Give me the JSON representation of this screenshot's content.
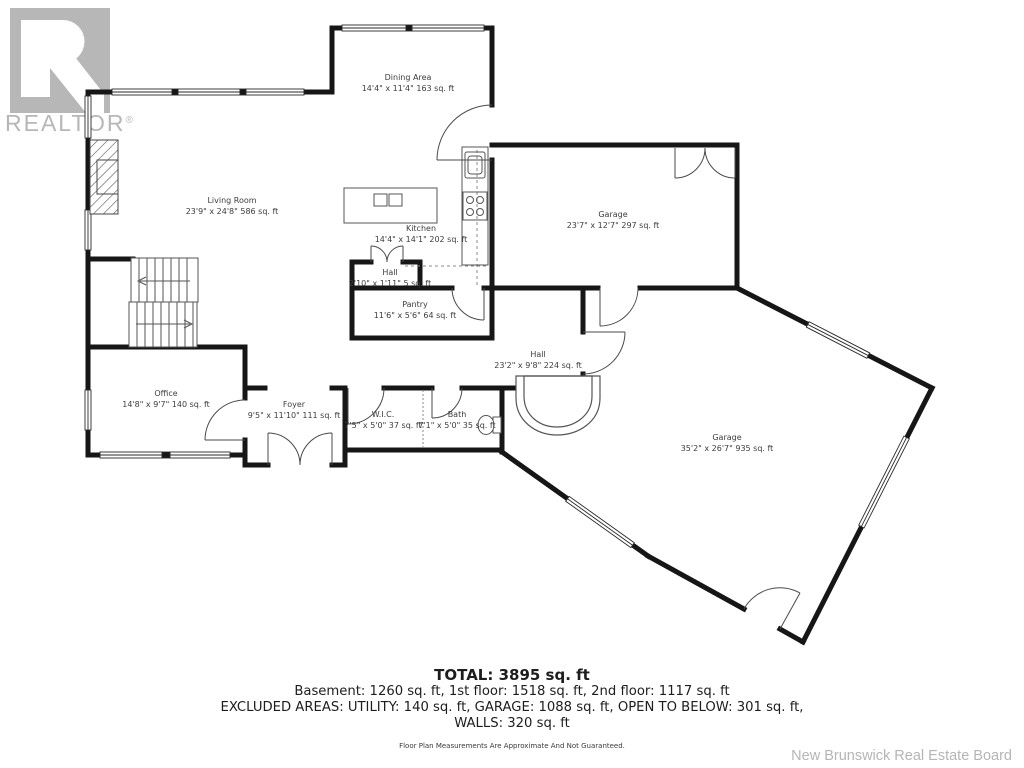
{
  "branding": {
    "logo_text": "REALTOR",
    "logo_reg": "®",
    "logo_color": "#b7b7b7"
  },
  "rooms": [
    {
      "id": "dining-area",
      "name": "Dining Area",
      "dims": "14'4\" x 11'4\" 163 sq. ft"
    },
    {
      "id": "living-room",
      "name": "Living Room",
      "dims": "23'9\" x 24'8\" 586 sq. ft"
    },
    {
      "id": "kitchen",
      "name": "Kitchen",
      "dims": "14'4\" x 14'1\" 202 sq. ft"
    },
    {
      "id": "garage-upper",
      "name": "Garage",
      "dims": "23'7\" x 12'7\" 297 sq. ft"
    },
    {
      "id": "hall-small",
      "name": "Hall",
      "dims": "2'10\" x 1'11\" 5 sq. ft"
    },
    {
      "id": "pantry",
      "name": "Pantry",
      "dims": "11'6\" x 5'6\" 64 sq. ft"
    },
    {
      "id": "hall-main",
      "name": "Hall",
      "dims": "23'2\" x 9'8\" 224 sq. ft"
    },
    {
      "id": "office",
      "name": "Office",
      "dims": "14'8\" x 9'7\" 140 sq. ft"
    },
    {
      "id": "foyer",
      "name": "Foyer",
      "dims": "9'5\" x 11'10\" 111 sq. ft"
    },
    {
      "id": "wic",
      "name": "W.I.C.",
      "dims": "7'5\" x 5'0\" 37 sq. ft"
    },
    {
      "id": "bath",
      "name": "Bath",
      "dims": "7'1\" x 5'0\" 35 sq. ft"
    },
    {
      "id": "garage-lower",
      "name": "Garage",
      "dims": "35'2\" x 26'7\" 935 sq. ft"
    }
  ],
  "summary": {
    "total": "TOTAL: 3895 sq. ft",
    "floors": "Basement: 1260 sq. ft, 1st floor: 1518 sq. ft, 2nd floor: 1117 sq. ft",
    "excluded": "EXCLUDED AREAS: UTILITY: 140 sq. ft, GARAGE: 1088 sq. ft, OPEN TO BELOW: 301 sq. ft,",
    "walls": "WALLS: 320 sq. ft",
    "disclaimer": "Floor Plan Measurements Are Approximate And Not Guaranteed."
  },
  "attribution": "New Brunswick Real Estate Board",
  "colors": {
    "wall": "#161616",
    "thin_line": "#4a4a4a",
    "label_text": "#3d3d3d",
    "muted_gray": "#b7b7b7"
  }
}
